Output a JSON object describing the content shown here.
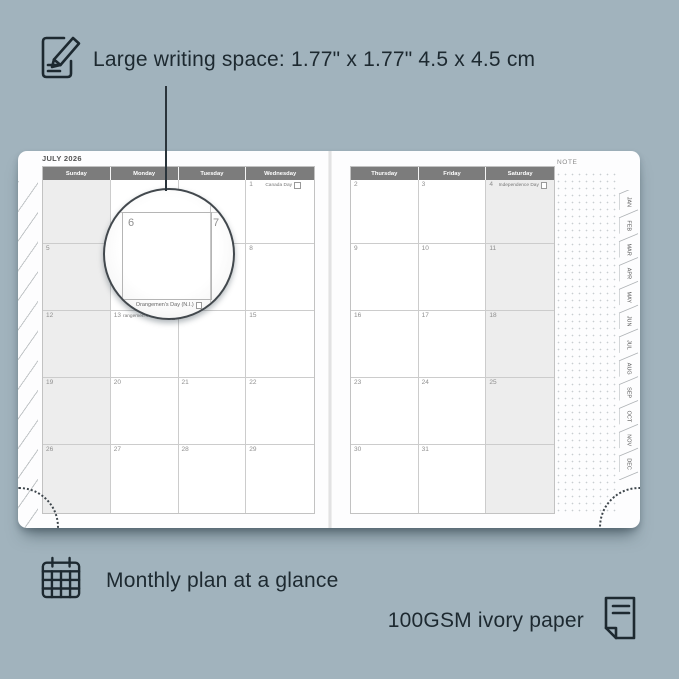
{
  "annotations": {
    "top": {
      "icon": "pencil-note-icon",
      "text": "Large writing space: 1.77\" x 1.77\" 4.5 x 4.5 cm"
    },
    "bottom_left": {
      "icon": "calendar-grid-icon",
      "text": "Monthly plan at a glance"
    },
    "bottom_right": {
      "icon": "paper-sheet-icon",
      "text": "100GSM ivory paper"
    }
  },
  "planner": {
    "title": "JULY 2026",
    "note_label": "NOTE",
    "left_page": {
      "day_headers": [
        "Sunday",
        "Monday",
        "Tuesday",
        "Wednesday"
      ],
      "weekend_column": 0,
      "cells": [
        {
          "date": "",
          "holiday": ""
        },
        {
          "date": "",
          "holiday": ""
        },
        {
          "date": "",
          "holiday": ""
        },
        {
          "date": "1",
          "holiday": "Canada Day"
        },
        {
          "date": "5",
          "holiday": ""
        },
        {
          "date": "6",
          "holiday": ""
        },
        {
          "date": "7",
          "holiday": ""
        },
        {
          "date": "8",
          "holiday": ""
        },
        {
          "date": "12",
          "holiday": ""
        },
        {
          "date": "13",
          "holiday": "Orangemen's Day (N.I.)"
        },
        {
          "date": "14",
          "holiday": ""
        },
        {
          "date": "15",
          "holiday": ""
        },
        {
          "date": "19",
          "holiday": ""
        },
        {
          "date": "20",
          "holiday": ""
        },
        {
          "date": "21",
          "holiday": ""
        },
        {
          "date": "22",
          "holiday": ""
        },
        {
          "date": "26",
          "holiday": ""
        },
        {
          "date": "27",
          "holiday": ""
        },
        {
          "date": "28",
          "holiday": ""
        },
        {
          "date": "29",
          "holiday": ""
        }
      ]
    },
    "right_page": {
      "day_headers": [
        "Thursday",
        "Friday",
        "Saturday"
      ],
      "weekend_column": 2,
      "cells": [
        {
          "date": "2",
          "holiday": ""
        },
        {
          "date": "3",
          "holiday": ""
        },
        {
          "date": "4",
          "holiday": "Independence Day"
        },
        {
          "date": "9",
          "holiday": ""
        },
        {
          "date": "10",
          "holiday": ""
        },
        {
          "date": "11",
          "holiday": ""
        },
        {
          "date": "16",
          "holiday": ""
        },
        {
          "date": "17",
          "holiday": ""
        },
        {
          "date": "18",
          "holiday": ""
        },
        {
          "date": "23",
          "holiday": ""
        },
        {
          "date": "24",
          "holiday": ""
        },
        {
          "date": "25",
          "holiday": ""
        },
        {
          "date": "30",
          "holiday": ""
        },
        {
          "date": "31",
          "holiday": ""
        },
        {
          "date": "",
          "holiday": ""
        }
      ]
    },
    "tabs": [
      "JAN",
      "FEB",
      "MAR",
      "APR",
      "MAY",
      "JUN",
      "JUL",
      "AUG",
      "SEP",
      "OCT",
      "NOV",
      "DEC"
    ],
    "magnifier": {
      "primary_date": "6",
      "secondary_date": "7",
      "caption": "Orangemen's Day (N.I.)"
    }
  },
  "colors": {
    "background": "#a1b3bd",
    "annotation_text": "#1d2930",
    "header_band": "#7c7c7c",
    "weekend_fill": "#ededed",
    "page": "#fdfdfe"
  }
}
